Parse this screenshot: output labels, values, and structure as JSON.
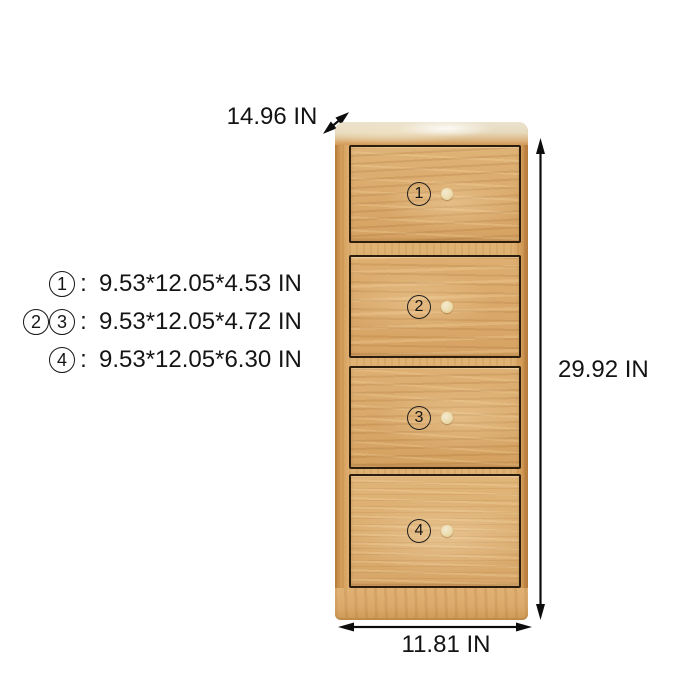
{
  "diagram_title": "4-drawer wooden cabinet dimension diagram",
  "dimensions": {
    "depth_label": "14.96 IN",
    "height_label": "29.92 IN",
    "width_label": "11.81 IN"
  },
  "specs": {
    "colon": ":",
    "rows": [
      {
        "nums": [
          "1"
        ],
        "text": "9.53*12.05*4.53 IN"
      },
      {
        "nums": [
          "2",
          "3"
        ],
        "text": "9.53*12.05*4.72 IN"
      },
      {
        "nums": [
          "4"
        ],
        "text": "9.53*12.05*6.30 IN"
      }
    ]
  },
  "drawers": [
    {
      "num": "1"
    },
    {
      "num": "2"
    },
    {
      "num": "3"
    },
    {
      "num": "4"
    }
  ],
  "colors": {
    "wood": "#dcab6c",
    "wood_top_highlight": "#ece3cf",
    "knob": "#ecddae",
    "annotation": "#131313",
    "background": "#ffffff"
  }
}
